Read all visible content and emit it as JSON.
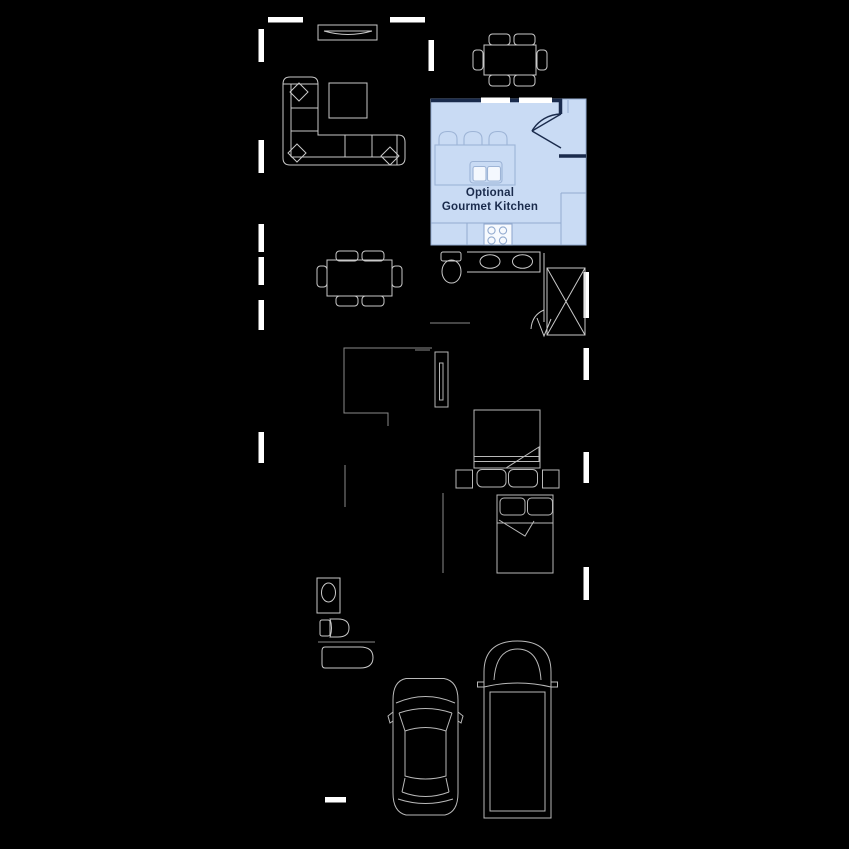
{
  "canvas": {
    "width": 849,
    "height": 849,
    "background": "#000000"
  },
  "floorplan": {
    "option_region": {
      "label_line1": "Optional",
      "label_line2": "Gourmet Kitchen",
      "fill": "#c9dbf4",
      "line_color": "#93abd0",
      "wall_color": "#1a2b4c",
      "text_color": "#1a2b4c",
      "window_color": "#ffffff",
      "appliance_fill": "#f4f8fe"
    },
    "line_colors": {
      "furniture": "#c9c9c9",
      "dim_wall": "#8a8a8a",
      "window_marker": "#ffffff"
    },
    "furniture": [
      "tv-console",
      "sectional-sofa",
      "coffee-table",
      "dining-table-6-chairs",
      "kitchen-island-with-stools",
      "kitchen-sink",
      "range-stove",
      "toilet",
      "double-vanity",
      "shower",
      "second-dining-table",
      "flex-room-door",
      "queen-bed-with-nightstands",
      "full-bed",
      "bath-vanity",
      "bathtub",
      "sedan-car",
      "suv-truck"
    ]
  }
}
